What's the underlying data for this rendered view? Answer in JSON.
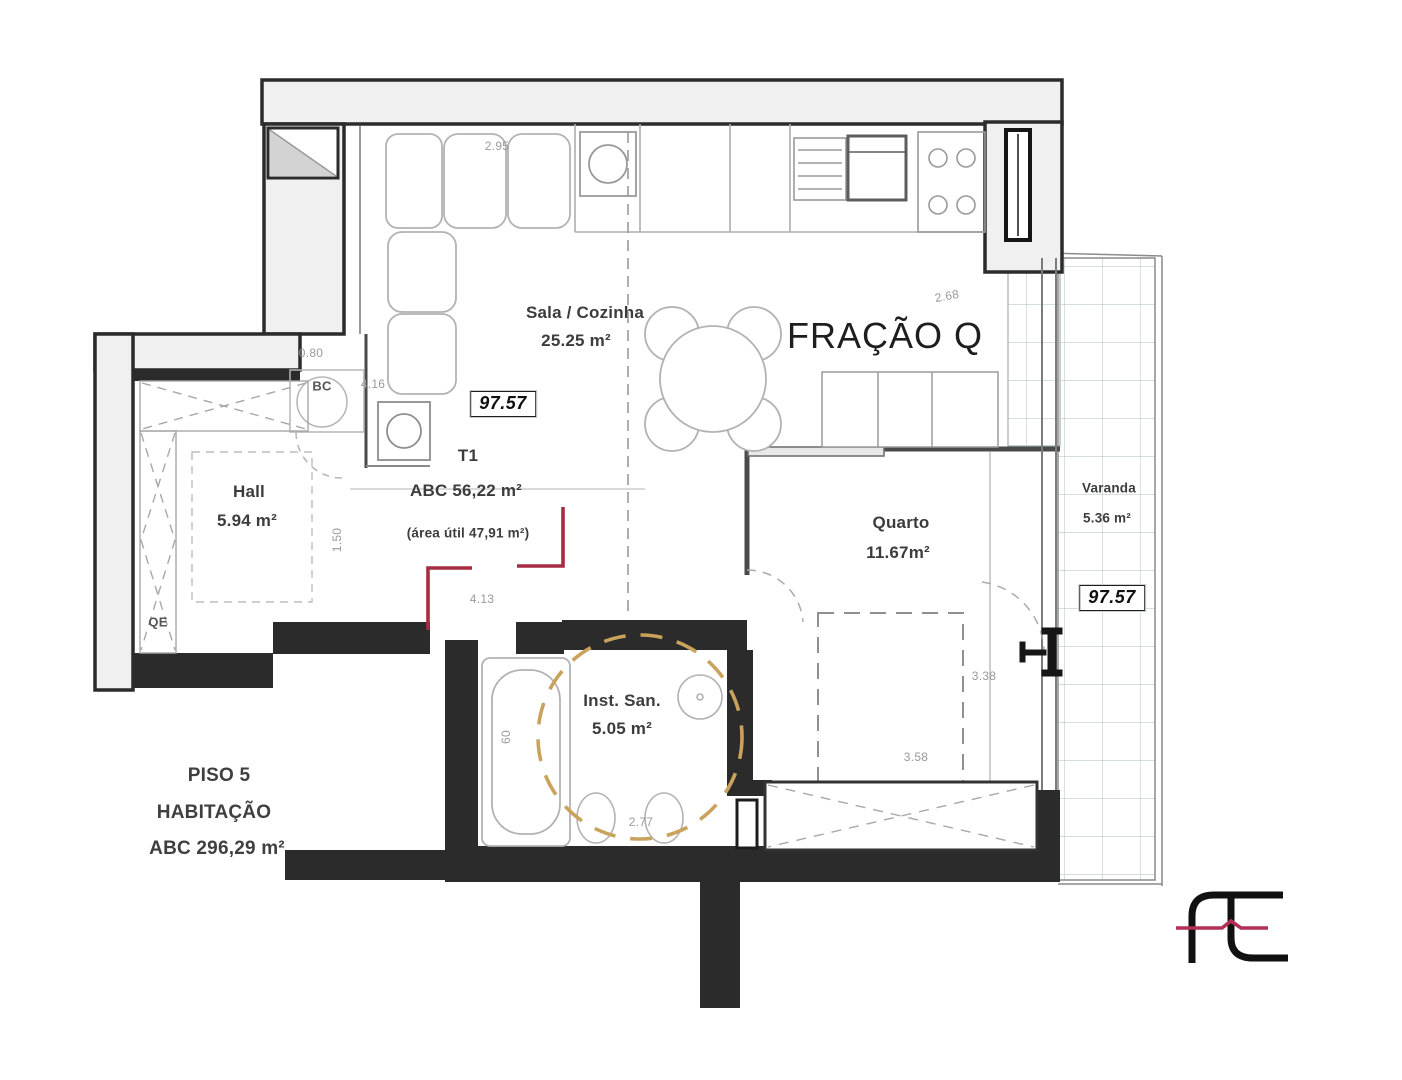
{
  "title": "FRAÇÃO Q",
  "rooms": {
    "sala": {
      "name": "Sala / Cozinha",
      "area": "25.25 m²"
    },
    "hall": {
      "name": "Hall",
      "area": "5.94 m²"
    },
    "quarto": {
      "name": "Quarto",
      "area": "11.67m²"
    },
    "inst": {
      "name": "Inst. San.",
      "area": "5.05 m²"
    },
    "varanda": {
      "name": "Varanda",
      "area": "5.36 m²"
    },
    "bc": "BC",
    "qe": "QE"
  },
  "typology": {
    "type": "T1",
    "abc": "ABC 56,22 m²",
    "util": "(área útil 47,91 m²)"
  },
  "floor": {
    "piso": "PISO 5",
    "use": "HABITAÇÃO",
    "abc": "ABC 296,29 m²"
  },
  "elevation": {
    "badge1": "97.57",
    "badge2": "97.57"
  },
  "dims": {
    "kitchen": "2.95",
    "quarto_top": "2.68",
    "bc": "0.80",
    "bc_right": "4.16",
    "hall": "1.50",
    "entrance": "4.13",
    "quarto_w": "3.58",
    "quarto_h": "3.38",
    "bath": "2.77",
    "tub": "60"
  },
  "colors": {
    "wall_dark": "#2b2b2b",
    "wall_fill": "#f0f0f0",
    "accent_red": "#a52c42",
    "dash_orange": "#c9a35c",
    "tile_grid": "#bccaca",
    "logo_pink": "#b13055"
  }
}
